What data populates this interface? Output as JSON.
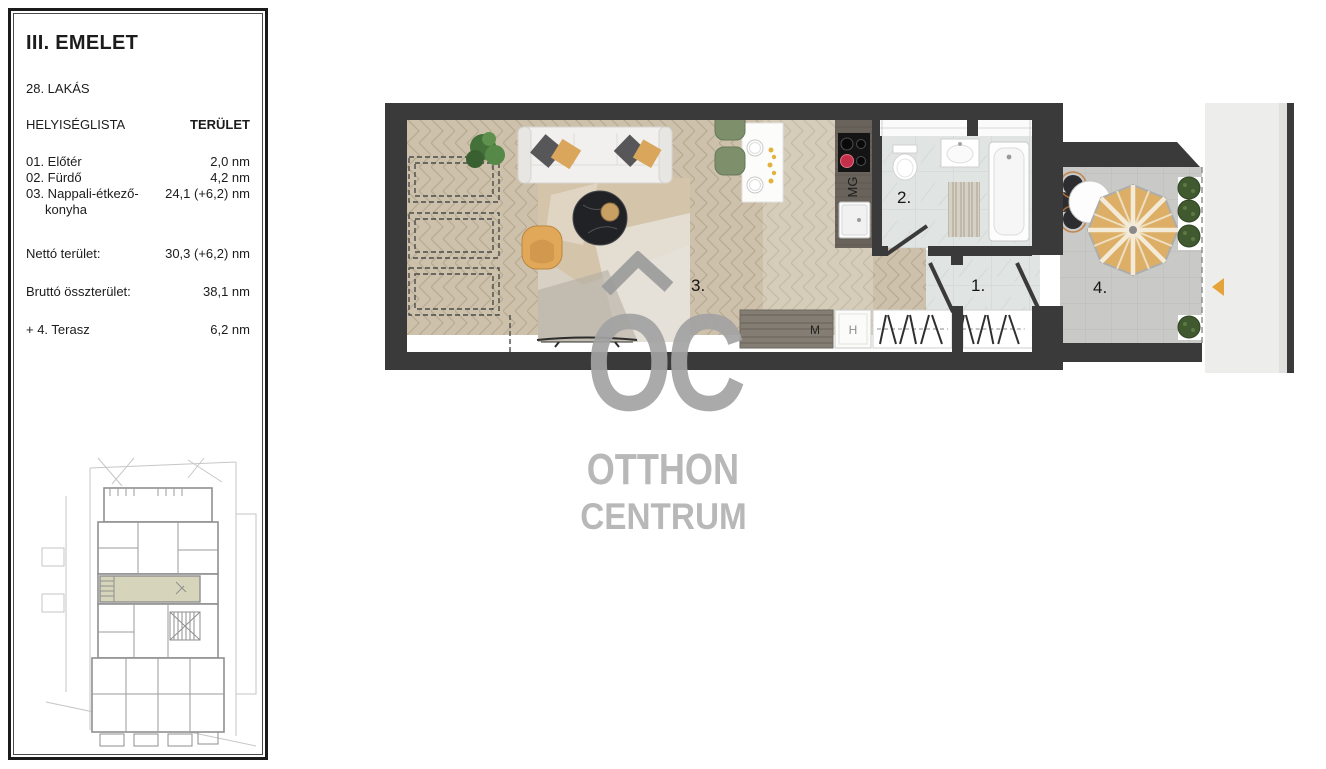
{
  "colors": {
    "wall": "#3a3a3a",
    "wood_floor": "#cdc1ab",
    "tile_floor": "#e0e4e2",
    "terrace_floor": "#c9c9c8",
    "walkway": "#ededeb",
    "highlight_unit": "#d6d5bb",
    "accent_arrow": "#e6a33c",
    "umbrella": "#ddae65",
    "watermark_gray": "#a6a6a6"
  },
  "sidebar": {
    "floor_title": "III. EMELET",
    "apartment": "28. LAKÁS",
    "list_header": "HELYISÉGLISTA",
    "area_header": "TERÜLET",
    "rooms": [
      {
        "label": "01. Előtér",
        "area": "2,0 nm"
      },
      {
        "label": "02. Fürdő",
        "area": "4,2 nm"
      },
      {
        "label": "03. Nappali-étkező-",
        "label2": "konyha",
        "area": "24,1 (+6,2) nm"
      }
    ],
    "net_label": "Nettó terület:",
    "net_value": "30,3 (+6,2) nm",
    "gross_label": "Bruttó összterület:",
    "gross_value": "38,1 nm",
    "terrace_label": "+ 4. Terasz",
    "terrace_value": "6,2 nm"
  },
  "plan": {
    "room_labels": {
      "hall": "1.",
      "bath": "2.",
      "living": "3.",
      "terrace": "4."
    },
    "appliance_labels": {
      "microwave": "MG",
      "washer": "M",
      "fridge": "H"
    }
  },
  "watermark": {
    "initials": "OC",
    "line1": "OTTHON",
    "line2": "CENTRUM"
  }
}
